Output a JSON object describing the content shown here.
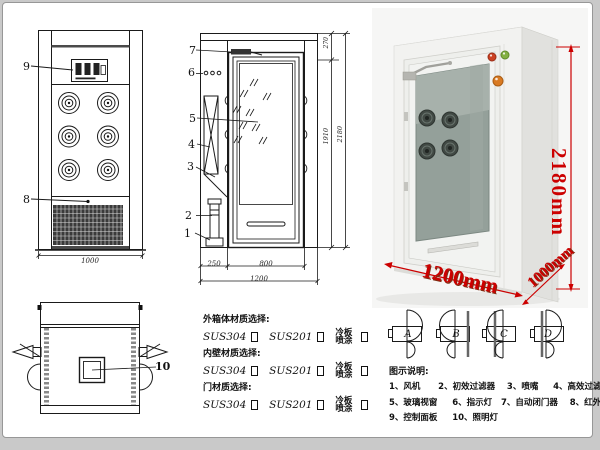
{
  "front_view": {
    "label_9": "9",
    "label_8": "8",
    "dim_width": "1000"
  },
  "side_view": {
    "label_7": "7",
    "label_6": "6",
    "label_5": "5",
    "label_4": "4",
    "label_3": "3",
    "label_2": "2",
    "label_1": "1",
    "dim_top": "270",
    "dim_door_h": "1910",
    "dim_total_h": "2180",
    "dim_left": "250",
    "dim_door_w": "800",
    "dim_total_w": "1200"
  },
  "top_view": {
    "label_10": "10"
  },
  "materials": {
    "outer_header": "外箱体材质选择:",
    "inner_header": "内壁材质选择:",
    "door_header": "门材质选择:",
    "opt_sus304": "SUS304",
    "opt_sus201": "SUS201",
    "opt_spray": "冷板喷涂"
  },
  "photo": {
    "dim_height": "2180mm",
    "dim_width": "1200mm",
    "dim_depth": "1000mm"
  },
  "door_options": {
    "a": "A",
    "b": "B",
    "c": "C",
    "d": "D"
  },
  "legend": {
    "title": "图示说明:",
    "line1": "1、风机      2、初效过滤器    3、喷嘴     4、高效过滤器",
    "line2": "5、玻璃视窗     6、指示灯   7、自动闭门器    8、红外线感应器",
    "line3": "9、控制面板     10、照明灯"
  },
  "colors": {
    "dim_red": "#cc0000",
    "line": "#1a1a1a"
  }
}
